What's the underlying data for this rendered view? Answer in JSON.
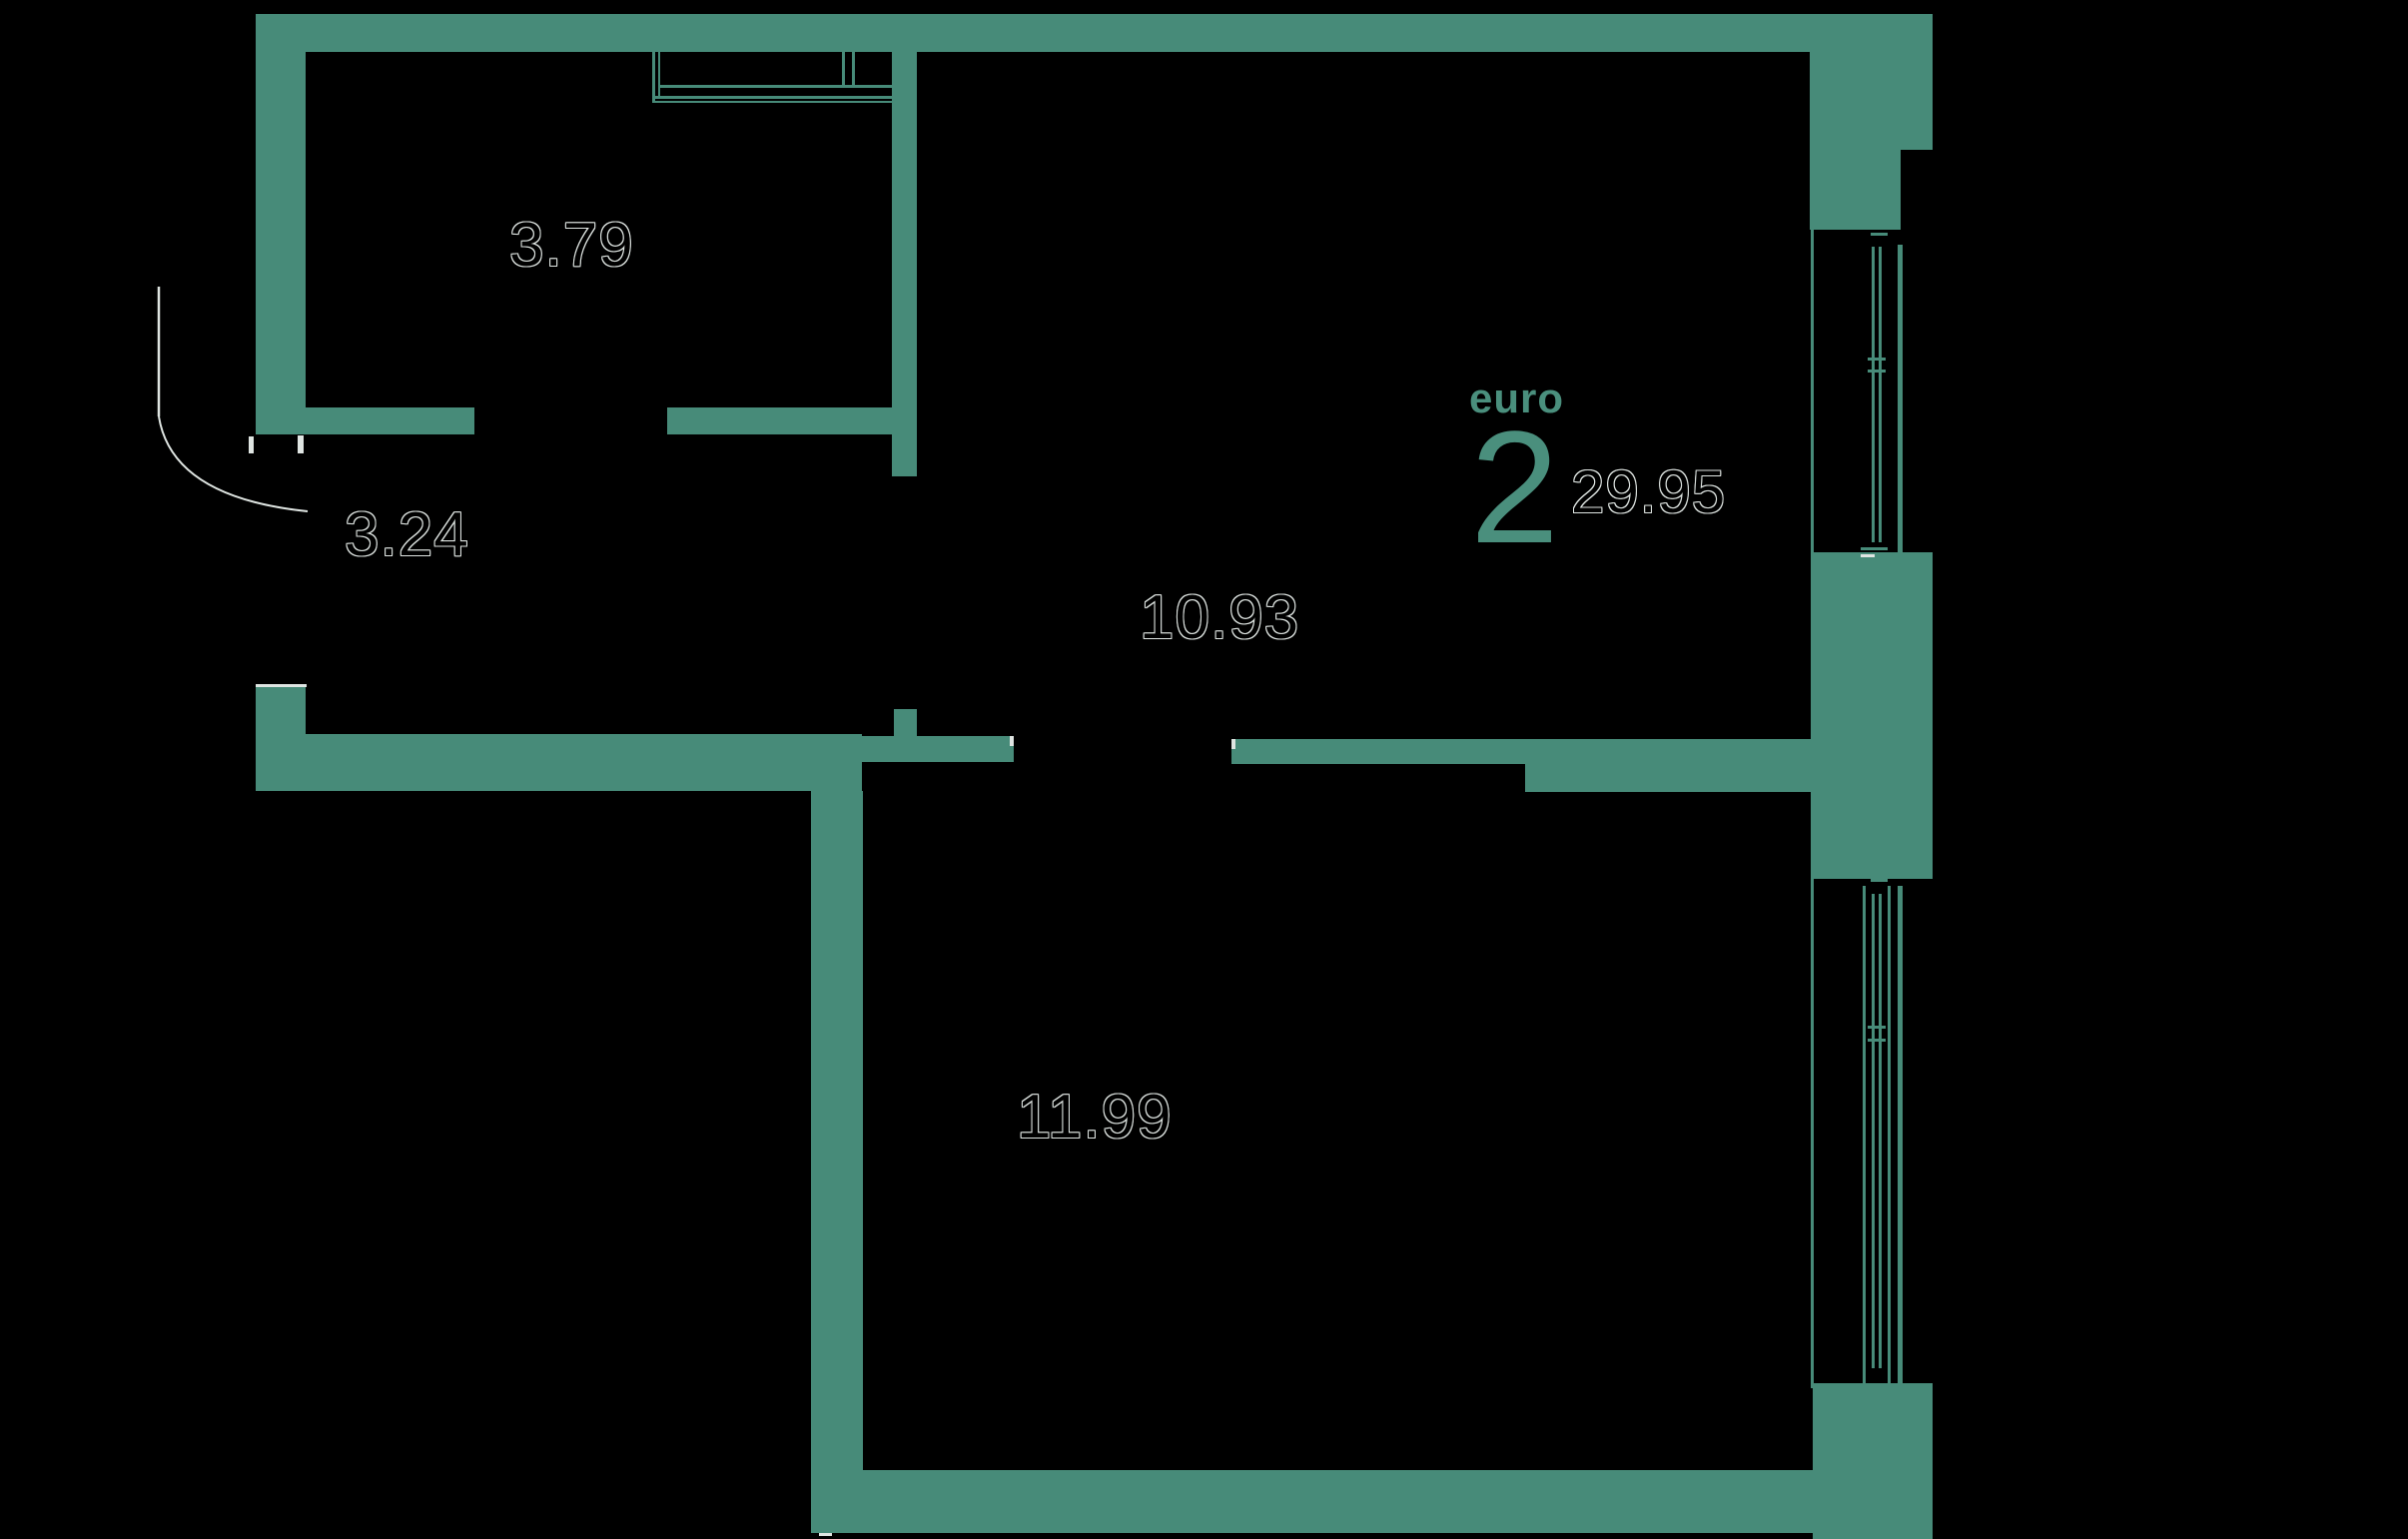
{
  "colors": {
    "bg": "#000000",
    "wall": "#478b79",
    "accent": "#4a8f7d",
    "outline": "#dfe5e2"
  },
  "plan": {
    "unit_type_label": "euro",
    "unit_type_number": "2",
    "total_area": "29.95",
    "rooms": [
      {
        "name": "room-top-left",
        "area": "3.79"
      },
      {
        "name": "hallway",
        "area": "3.24"
      },
      {
        "name": "kitchen-living-room",
        "area": "10.93"
      },
      {
        "name": "bedroom",
        "area": "11.99"
      }
    ]
  }
}
